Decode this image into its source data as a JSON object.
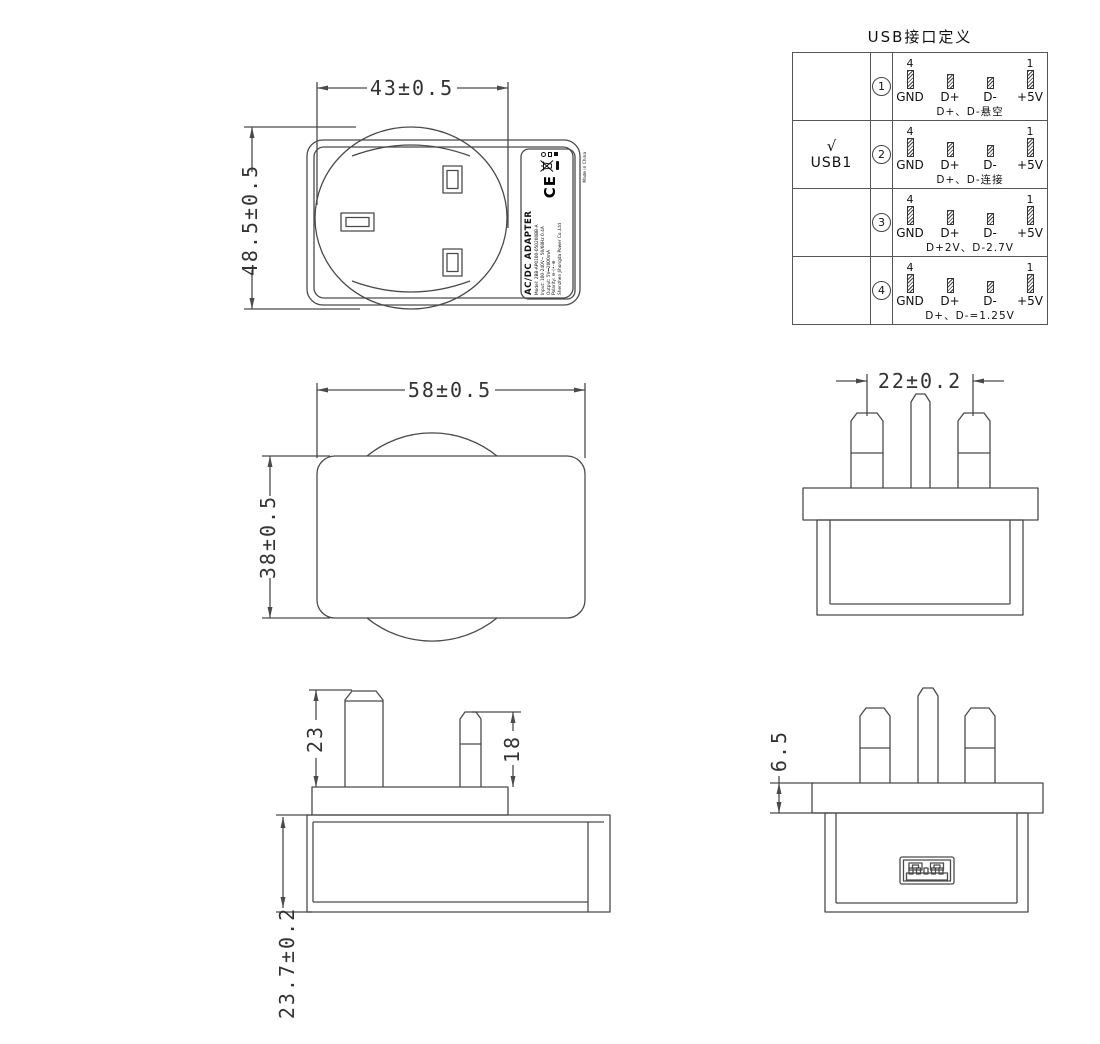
{
  "table": {
    "title": "USB接口定义",
    "pin4": "4",
    "pin1": "1",
    "pin_labels": [
      "GND",
      "D+",
      "D-",
      "+5V"
    ],
    "rows": [
      {
        "num": "1",
        "port_check": "",
        "port": "",
        "note": "D+、D-悬空"
      },
      {
        "num": "2",
        "port_check": "√",
        "port": "USB1",
        "note": "D+、D-连接"
      },
      {
        "num": "3",
        "port_check": "",
        "port": "",
        "note": "D+2V、D-2.7V"
      },
      {
        "num": "4",
        "port_check": "",
        "port": "",
        "note": "D+、D-=1.25V"
      }
    ]
  },
  "dims": {
    "back_width": "43±0.5",
    "back_height": "48.5±0.5",
    "side_width": "58±0.5",
    "side_height": "38±0.5",
    "pin_pitch": "22±0.2",
    "earth_pin_length": "23",
    "power_pin_length": "18",
    "body_depth": "23.7±0.2",
    "flange_thickness": "6.5"
  },
  "label": {
    "product": "AC/DC ADAPTER",
    "model": "Model: 2BB-AP0100-050200BB-A",
    "input": "Input: 100-240V~ 50/60Hz 0.4A",
    "output": "Output: 5V⎓2000mA",
    "polarity": "Polarity: ⊖–(•–⊕",
    "maker": "Shenzhen Jihongda Power Co.,Ltd",
    "ce": "CE",
    "made_in": "Made in China"
  }
}
